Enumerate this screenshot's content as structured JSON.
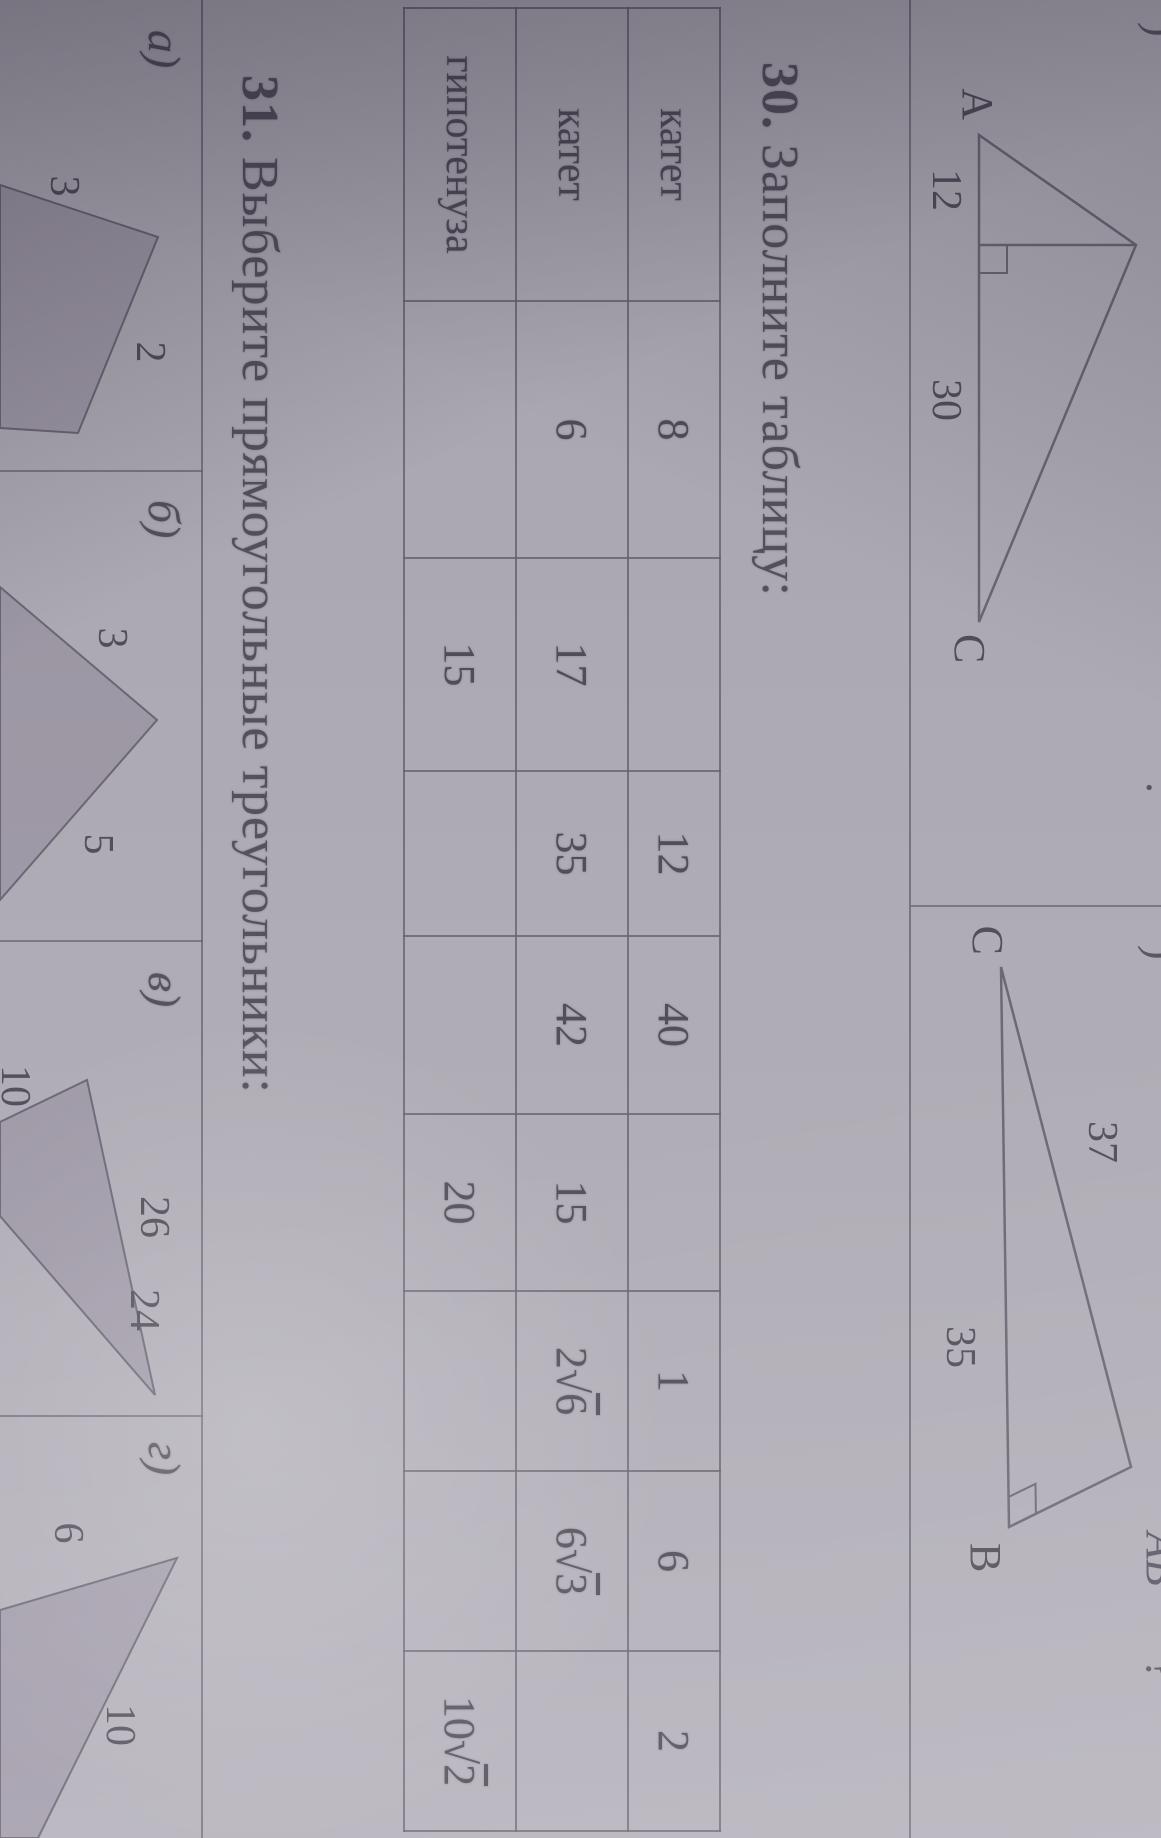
{
  "colors": {
    "paper": "#b4b0ba",
    "ink": "#524e5b",
    "line": "#686372",
    "triangle_fill": "#a19baa"
  },
  "problem30": {
    "number": "30.",
    "title": "Заполните таблицу:"
  },
  "problem31": {
    "number": "31.",
    "title": "Выберите прямоугольные треугольники:"
  },
  "table": {
    "row_headers": [
      "катет",
      "катет",
      "гипотенуза"
    ],
    "columns": [
      {
        "values": [
          "8",
          "6",
          ""
        ]
      },
      {
        "values": [
          "",
          "17",
          "15"
        ]
      },
      {
        "values": [
          "12",
          "35",
          ""
        ]
      },
      {
        "values": [
          "40",
          "42",
          ""
        ]
      },
      {
        "values": [
          "",
          "15",
          "20"
        ]
      },
      {
        "values": [
          "1",
          "2√6",
          ""
        ]
      },
      {
        "values": [
          "6",
          "6√3",
          ""
        ]
      },
      {
        "values": [
          "2",
          "",
          "10√2"
        ]
      }
    ]
  },
  "figure1": {
    "vertex_a": "A",
    "vertex_c": "C",
    "segment_left": "12",
    "segment_right": "30"
  },
  "figure2": {
    "vertex_c": "C",
    "vertex_b": "B",
    "side_ca": "37",
    "side_cb": "35"
  },
  "strip": [
    {
      "label": "а)",
      "side1": "3",
      "side2": "2"
    },
    {
      "label": "б)",
      "side1": "3",
      "side2": "5"
    },
    {
      "label": "в)",
      "side1": "26",
      "side2": "24",
      "side3": "10"
    },
    {
      "label": "г)",
      "side1": "6",
      "side2": "10"
    }
  ],
  "edge_fragments": {
    "f1": ")",
    "f2": ".",
    "f3": ")",
    "f4": "АВ",
    "f5": "?"
  }
}
